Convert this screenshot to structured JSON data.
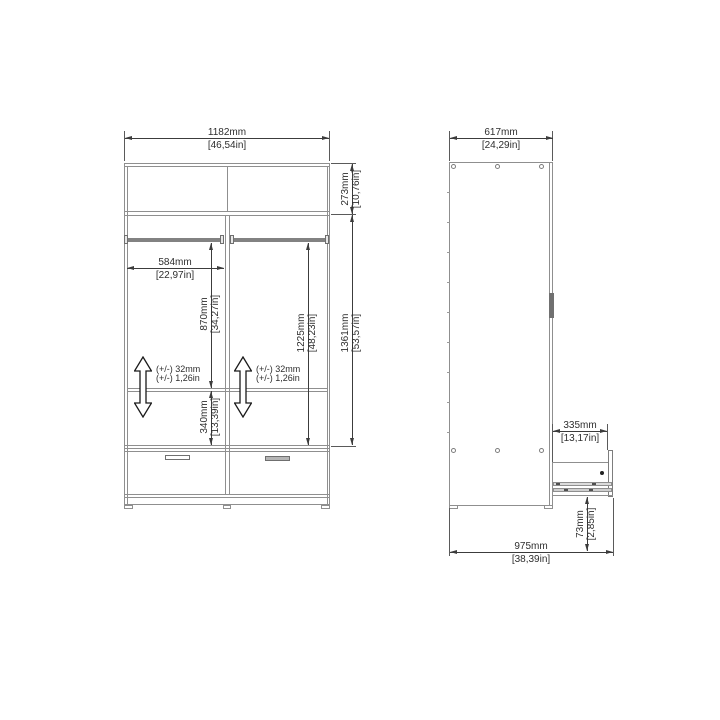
{
  "drawing": {
    "type": "wardrobe dimension drawing",
    "views": [
      "front",
      "side"
    ]
  },
  "front_view": {
    "overall_width": {
      "mm": "1182mm",
      "inch": "[46,54in]"
    },
    "top_section_height": {
      "mm": "273mm",
      "inch": "[10,76in]"
    },
    "body_height": {
      "mm": "1361mm",
      "inch": "[53,57in]"
    },
    "compartment_width": {
      "mm": "584mm",
      "inch": "[22,97in]"
    },
    "left_hanging_height": {
      "mm": "870mm",
      "inch": "[34,27in]"
    },
    "right_hanging_height": {
      "mm": "1225mm",
      "inch": "[48,23in]"
    },
    "bottom_section_height": {
      "mm": "340mm",
      "inch": "[13,39in]"
    },
    "shelf_tolerance": {
      "mm": "(+/-) 32mm",
      "inch": "(+/-) 1,26in"
    }
  },
  "side_view": {
    "depth": {
      "mm": "617mm",
      "inch": "[24,29in]"
    },
    "drawer_extension": {
      "mm": "335mm",
      "inch": "[13,17in]"
    },
    "drawer_bottom_clearance": {
      "mm": "73mm",
      "inch": "[2,85in]"
    },
    "depth_drawer_open": {
      "mm": "975mm",
      "inch": "[38,39in]"
    }
  },
  "colors": {
    "background": "#ffffff",
    "furniture_line": "#8f8f8f",
    "dimension_line": "#3c3c3c",
    "text": "#2e2e2e"
  }
}
